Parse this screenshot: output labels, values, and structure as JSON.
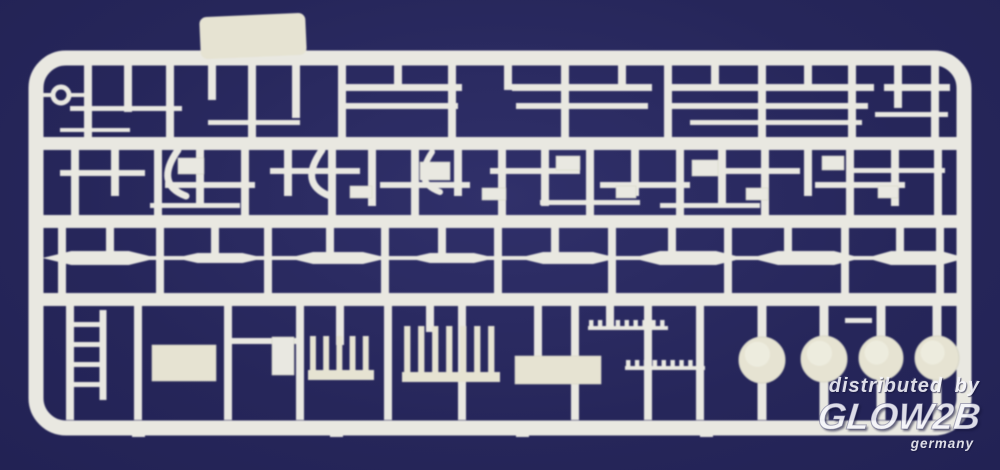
{
  "watermark": {
    "line1": "distributed by",
    "brand": "GLOW2B",
    "country": "germany",
    "color": "#f7f7fc"
  },
  "scene": {
    "background": "#26265a",
    "background_light": "#30306a",
    "plastic": "#e9e8e1",
    "plastic_cream": "#e6e3d2",
    "plastic_edge": "#d6d5c6",
    "frame": {
      "x": 36,
      "y": 58,
      "w": 928,
      "h": 370,
      "rx": 30,
      "stroke_w": 15
    },
    "tab": {
      "x": 200,
      "y": 15,
      "w": 106,
      "h": 42,
      "rx": 7,
      "tilt": -2.5
    },
    "rails": [
      {
        "x1": 42,
        "x2": 958,
        "y": 137,
        "h": 13
      },
      {
        "x1": 42,
        "x2": 958,
        "y": 215,
        "h": 13
      },
      {
        "x1": 42,
        "x2": 958,
        "y": 293,
        "h": 13
      }
    ],
    "verticals": [
      {
        "x": 88,
        "y1": 62,
        "y2": 150
      },
      {
        "x": 128,
        "y1": 62,
        "y2": 112
      },
      {
        "x": 170,
        "y1": 62,
        "y2": 150
      },
      {
        "x": 212,
        "y1": 62,
        "y2": 100
      },
      {
        "x": 252,
        "y1": 62,
        "y2": 150
      },
      {
        "x": 296,
        "y1": 62,
        "y2": 118
      },
      {
        "x": 342,
        "y1": 62,
        "y2": 150
      },
      {
        "x": 398,
        "y1": 62,
        "y2": 90
      },
      {
        "x": 452,
        "y1": 62,
        "y2": 150
      },
      {
        "x": 508,
        "y1": 62,
        "y2": 90
      },
      {
        "x": 565,
        "y1": 62,
        "y2": 150
      },
      {
        "x": 622,
        "y1": 62,
        "y2": 90
      },
      {
        "x": 668,
        "y1": 62,
        "y2": 150
      },
      {
        "x": 715,
        "y1": 62,
        "y2": 90
      },
      {
        "x": 762,
        "y1": 62,
        "y2": 150
      },
      {
        "x": 808,
        "y1": 62,
        "y2": 90
      },
      {
        "x": 852,
        "y1": 62,
        "y2": 150
      },
      {
        "x": 898,
        "y1": 62,
        "y2": 108
      },
      {
        "x": 935,
        "y1": 62,
        "y2": 150
      },
      {
        "x": 75,
        "y1": 145,
        "y2": 222
      },
      {
        "x": 115,
        "y1": 145,
        "y2": 196
      },
      {
        "x": 158,
        "y1": 145,
        "y2": 222
      },
      {
        "x": 200,
        "y1": 145,
        "y2": 206
      },
      {
        "x": 245,
        "y1": 145,
        "y2": 222
      },
      {
        "x": 288,
        "y1": 145,
        "y2": 196
      },
      {
        "x": 332,
        "y1": 145,
        "y2": 222
      },
      {
        "x": 372,
        "y1": 145,
        "y2": 206
      },
      {
        "x": 415,
        "y1": 145,
        "y2": 222
      },
      {
        "x": 458,
        "y1": 145,
        "y2": 196
      },
      {
        "x": 502,
        "y1": 145,
        "y2": 222
      },
      {
        "x": 545,
        "y1": 145,
        "y2": 206
      },
      {
        "x": 590,
        "y1": 145,
        "y2": 222
      },
      {
        "x": 635,
        "y1": 145,
        "y2": 196
      },
      {
        "x": 680,
        "y1": 145,
        "y2": 222
      },
      {
        "x": 722,
        "y1": 145,
        "y2": 206
      },
      {
        "x": 765,
        "y1": 145,
        "y2": 222
      },
      {
        "x": 808,
        "y1": 145,
        "y2": 196
      },
      {
        "x": 850,
        "y1": 145,
        "y2": 222
      },
      {
        "x": 895,
        "y1": 145,
        "y2": 206
      },
      {
        "x": 938,
        "y1": 145,
        "y2": 222
      },
      {
        "x": 62,
        "y1": 222,
        "y2": 300
      },
      {
        "x": 160,
        "y1": 222,
        "y2": 300
      },
      {
        "x": 268,
        "y1": 222,
        "y2": 300
      },
      {
        "x": 385,
        "y1": 222,
        "y2": 300
      },
      {
        "x": 498,
        "y1": 222,
        "y2": 300
      },
      {
        "x": 612,
        "y1": 222,
        "y2": 300
      },
      {
        "x": 728,
        "y1": 222,
        "y2": 300
      },
      {
        "x": 845,
        "y1": 222,
        "y2": 300
      },
      {
        "x": 940,
        "y1": 222,
        "y2": 300
      },
      {
        "x": 110,
        "y1": 222,
        "y2": 260
      },
      {
        "x": 215,
        "y1": 222,
        "y2": 260
      },
      {
        "x": 330,
        "y1": 222,
        "y2": 260
      },
      {
        "x": 442,
        "y1": 222,
        "y2": 260
      },
      {
        "x": 555,
        "y1": 222,
        "y2": 260
      },
      {
        "x": 672,
        "y1": 222,
        "y2": 260
      },
      {
        "x": 788,
        "y1": 222,
        "y2": 260
      },
      {
        "x": 900,
        "y1": 222,
        "y2": 260
      },
      {
        "x": 70,
        "y1": 300,
        "y2": 420
      },
      {
        "x": 103,
        "y1": 310,
        "y2": 400,
        "w": 7
      },
      {
        "x": 138,
        "y1": 300,
        "y2": 420
      },
      {
        "x": 228,
        "y1": 300,
        "y2": 420
      },
      {
        "x": 300,
        "y1": 300,
        "y2": 420
      },
      {
        "x": 340,
        "y1": 300,
        "y2": 345
      },
      {
        "x": 388,
        "y1": 300,
        "y2": 420
      },
      {
        "x": 430,
        "y1": 300,
        "y2": 332
      },
      {
        "x": 462,
        "y1": 300,
        "y2": 420
      },
      {
        "x": 538,
        "y1": 300,
        "y2": 360
      },
      {
        "x": 575,
        "y1": 300,
        "y2": 420
      },
      {
        "x": 610,
        "y1": 300,
        "y2": 326
      },
      {
        "x": 648,
        "y1": 300,
        "y2": 420
      },
      {
        "x": 700,
        "y1": 300,
        "y2": 420
      },
      {
        "x": 762,
        "y1": 300,
        "y2": 420,
        "w": 9
      },
      {
        "x": 824,
        "y1": 300,
        "y2": 420,
        "w": 9
      },
      {
        "x": 881,
        "y1": 300,
        "y2": 420,
        "w": 9
      },
      {
        "x": 937,
        "y1": 300,
        "y2": 420,
        "w": 9
      }
    ],
    "hbars": [
      {
        "x1": 338,
        "x2": 462,
        "y": 84,
        "h": 7
      },
      {
        "x1": 512,
        "x2": 652,
        "y": 84,
        "h": 7
      },
      {
        "x1": 666,
        "x2": 874,
        "y": 84,
        "h": 7
      },
      {
        "x1": 884,
        "x2": 950,
        "y": 84,
        "h": 7
      },
      {
        "x1": 344,
        "x2": 458,
        "y": 103,
        "h": 6
      },
      {
        "x1": 516,
        "x2": 648,
        "y": 103,
        "h": 6
      },
      {
        "x1": 672,
        "x2": 868,
        "y": 103,
        "h": 6
      },
      {
        "x1": 70,
        "x2": 182,
        "y": 106,
        "h": 5
      },
      {
        "x1": 208,
        "x2": 300,
        "y": 120,
        "h": 5
      },
      {
        "x1": 60,
        "x2": 130,
        "y": 128,
        "h": 4
      },
      {
        "x1": 690,
        "x2": 862,
        "y": 120,
        "h": 5
      },
      {
        "x1": 875,
        "x2": 948,
        "y": 112,
        "h": 5
      },
      {
        "x1": 40,
        "x2": 54,
        "y": 93,
        "h": 4
      },
      {
        "x1": 68,
        "x2": 90,
        "y": 93,
        "h": 4
      },
      {
        "x1": 60,
        "x2": 145,
        "y": 170,
        "h": 6
      },
      {
        "x1": 165,
        "x2": 255,
        "y": 182,
        "h": 6
      },
      {
        "x1": 270,
        "x2": 360,
        "y": 168,
        "h": 6
      },
      {
        "x1": 380,
        "x2": 470,
        "y": 182,
        "h": 6
      },
      {
        "x1": 490,
        "x2": 580,
        "y": 168,
        "h": 6
      },
      {
        "x1": 600,
        "x2": 690,
        "y": 182,
        "h": 6
      },
      {
        "x1": 705,
        "x2": 800,
        "y": 168,
        "h": 6
      },
      {
        "x1": 815,
        "x2": 905,
        "y": 182,
        "h": 6
      },
      {
        "x1": 540,
        "x2": 640,
        "y": 200,
        "h": 5
      },
      {
        "x1": 150,
        "x2": 240,
        "y": 203,
        "h": 5
      },
      {
        "x1": 660,
        "x2": 760,
        "y": 203,
        "h": 5
      },
      {
        "x1": 848,
        "x2": 945,
        "y": 168,
        "h": 5
      },
      {
        "x1": 68,
        "x2": 106,
        "y": 322,
        "h": 5
      },
      {
        "x1": 68,
        "x2": 106,
        "y": 342,
        "h": 5
      },
      {
        "x1": 68,
        "x2": 106,
        "y": 362,
        "h": 5
      },
      {
        "x1": 68,
        "x2": 106,
        "y": 382,
        "h": 5
      },
      {
        "x1": 228,
        "x2": 298,
        "y": 338,
        "h": 6
      },
      {
        "x1": 845,
        "x2": 872,
        "y": 318,
        "h": 5
      }
    ],
    "rects": [
      {
        "x": 152,
        "y": 345,
        "w": 64,
        "h": 36,
        "c": "cream"
      },
      {
        "x": 515,
        "y": 356,
        "w": 86,
        "h": 28,
        "c": "cream"
      },
      {
        "x": 272,
        "y": 337,
        "w": 22,
        "h": 38
      },
      {
        "x": 178,
        "y": 158,
        "w": 26,
        "h": 16
      },
      {
        "x": 420,
        "y": 162,
        "w": 30,
        "h": 18
      },
      {
        "x": 556,
        "y": 156,
        "w": 24,
        "h": 14
      },
      {
        "x": 692,
        "y": 160,
        "w": 26,
        "h": 16
      },
      {
        "x": 822,
        "y": 156,
        "w": 22,
        "h": 14
      },
      {
        "x": 350,
        "y": 186,
        "w": 22,
        "h": 12
      },
      {
        "x": 482,
        "y": 188,
        "w": 24,
        "h": 12
      },
      {
        "x": 616,
        "y": 186,
        "w": 20,
        "h": 12
      },
      {
        "x": 746,
        "y": 188,
        "w": 22,
        "h": 12
      },
      {
        "x": 878,
        "y": 186,
        "w": 20,
        "h": 12
      }
    ],
    "paths": [
      {
        "d": "M178,150 q-24,34 8,46",
        "w": 7
      },
      {
        "d": "M322,150 q-24,34 8,46",
        "w": 7
      },
      {
        "d": "M432,152 q-20,30 8,40",
        "w": 6
      }
    ],
    "combs": [
      {
        "x": 308,
        "y": 336,
        "w": 66,
        "h": 44,
        "teeth": 5
      },
      {
        "x": 402,
        "y": 326,
        "w": 98,
        "h": 56,
        "teeth": 7
      }
    ],
    "bumpstrips": [
      {
        "x1": 588,
        "x2": 668,
        "y": 326,
        "n": 9
      },
      {
        "x1": 625,
        "x2": 705,
        "y": 366,
        "n": 9
      }
    ],
    "spindle_line": {
      "x1": 52,
      "x2": 950,
      "y": 258
    },
    "spindles": [
      {
        "cx": 100,
        "len": 115,
        "r": 7
      },
      {
        "cx": 220,
        "len": 90,
        "r": 5
      },
      {
        "cx": 338,
        "len": 100,
        "r": 6
      },
      {
        "cx": 452,
        "len": 88,
        "r": 5
      },
      {
        "cx": 568,
        "len": 100,
        "r": 6
      },
      {
        "cx": 688,
        "len": 112,
        "r": 7
      },
      {
        "cx": 806,
        "len": 112,
        "r": 7
      },
      {
        "cx": 916,
        "len": 100,
        "r": 7
      }
    ],
    "discs": [
      {
        "cx": 762,
        "cy": 360,
        "r": 23
      },
      {
        "cx": 824,
        "cy": 359,
        "r": 23
      },
      {
        "cx": 881,
        "cy": 358,
        "r": 22
      },
      {
        "cx": 937,
        "cy": 358,
        "r": 22
      }
    ],
    "ring": {
      "cx": 61,
      "cy": 95,
      "r": 8
    },
    "stubs": [
      {
        "x": 132,
        "y": 428,
        "w": 13,
        "h": 9
      },
      {
        "x": 330,
        "y": 428,
        "w": 13,
        "h": 9
      },
      {
        "x": 516,
        "y": 428,
        "w": 13,
        "h": 9
      },
      {
        "x": 700,
        "y": 428,
        "w": 13,
        "h": 9
      }
    ]
  }
}
